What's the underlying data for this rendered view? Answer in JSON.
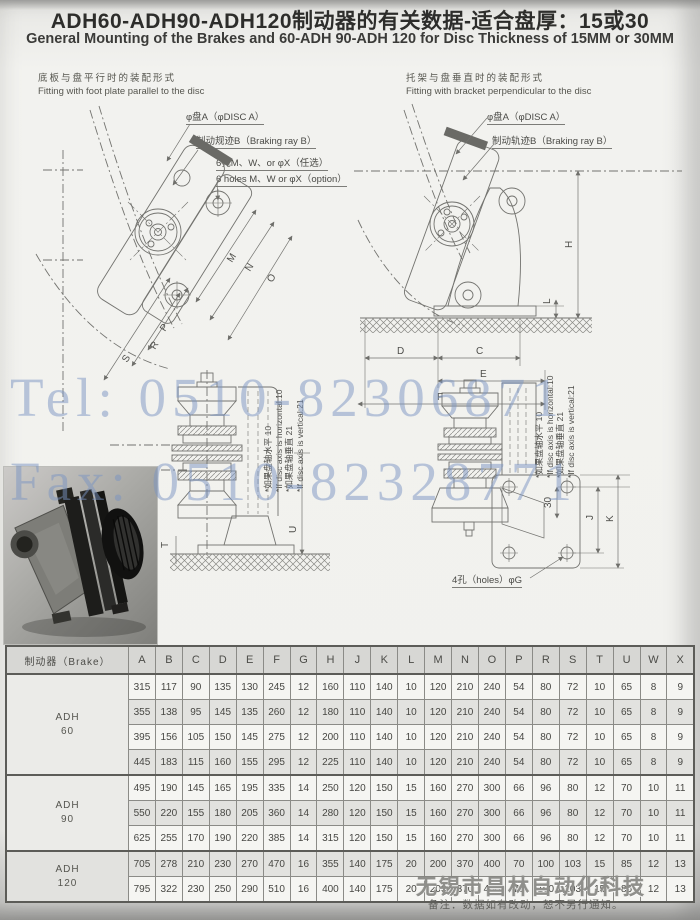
{
  "header": {
    "title_cn": "ADH60-ADH90-ADH120制动器的有关数据-适合盘厚：15或30",
    "title_en": "General Mounting of the Brakes and 60-ADH 90-ADH 120 for Disc Thickness of 15MM or 30MM"
  },
  "panels": {
    "left": {
      "caption_cn": "底板与盘平行时的装配形式",
      "caption_en": "Fitting with foot plate parallel to the disc",
      "callout_disc": "φ盘A（φDISC A）",
      "callout_ray": "制动规迹B（Braking ray B）",
      "callout_holes_cn": "6孔M、W、or φX（任选）",
      "callout_holes_en": "6 holes M、W or φX（option）",
      "dims": {
        "m": "M",
        "n": "N",
        "o": "O",
        "p": "P",
        "r": "R",
        "s": "S",
        "t": "T",
        "u": "U"
      }
    },
    "right": {
      "caption_cn": "托架与盘垂直时的装配形式",
      "caption_en": "Fitting with bracket perpendicular to the disc",
      "callout_disc": "φ盘A（φDISC A）",
      "callout_ray": "制动轨迹B（Braking ray B）",
      "holes_label": "4孔（holes）φG",
      "dims": {
        "d": "D",
        "c": "C",
        "e": "E",
        "f": "F",
        "h": "H",
        "l": "L",
        "j": "J",
        "k": "K",
        "offset": "30"
      }
    }
  },
  "annotations": {
    "line1_cn": "*如果盘轴水平  10",
    "line1_en": "*If disc axis is horizontal:10",
    "line2_cn": "*如果盘轴垂直  21",
    "line2_en": "*If disc axis is vertical:21"
  },
  "watermark": {
    "tel": "Tel: 0510-82306871",
    "fax": "Fax: 0510-82328771",
    "color": "#7a94c2"
  },
  "table": {
    "brake_header": "制动器（Brake）",
    "columns": [
      "A",
      "B",
      "C",
      "D",
      "E",
      "F",
      "G",
      "H",
      "J",
      "K",
      "L",
      "M",
      "N",
      "O",
      "P",
      "R",
      "S",
      "T",
      "U",
      "W",
      "X"
    ],
    "groups": [
      {
        "model": "ADH",
        "size": "60",
        "rows": [
          [
            315,
            117,
            90,
            135,
            130,
            245,
            12,
            160,
            110,
            140,
            10,
            120,
            210,
            240,
            54,
            80,
            72,
            10,
            65,
            8,
            9
          ],
          [
            355,
            138,
            95,
            145,
            135,
            260,
            12,
            180,
            110,
            140,
            10,
            120,
            210,
            240,
            54,
            80,
            72,
            10,
            65,
            8,
            9
          ],
          [
            395,
            156,
            105,
            150,
            145,
            275,
            12,
            200,
            110,
            140,
            10,
            120,
            210,
            240,
            54,
            80,
            72,
            10,
            65,
            8,
            9
          ],
          [
            445,
            183,
            115,
            160,
            155,
            295,
            12,
            225,
            110,
            140,
            10,
            120,
            210,
            240,
            54,
            80,
            72,
            10,
            65,
            8,
            9
          ]
        ]
      },
      {
        "model": "ADH",
        "size": "90",
        "rows": [
          [
            495,
            190,
            145,
            165,
            195,
            335,
            14,
            250,
            120,
            150,
            15,
            160,
            270,
            300,
            66,
            96,
            80,
            12,
            70,
            10,
            11
          ],
          [
            550,
            220,
            155,
            180,
            205,
            360,
            14,
            280,
            120,
            150,
            15,
            160,
            270,
            300,
            66,
            96,
            80,
            12,
            70,
            10,
            11
          ],
          [
            625,
            255,
            170,
            190,
            220,
            385,
            14,
            315,
            120,
            150,
            15,
            160,
            270,
            300,
            66,
            96,
            80,
            12,
            70,
            10,
            11
          ]
        ]
      },
      {
        "model": "ADH",
        "size": "120",
        "rows": [
          [
            705,
            278,
            210,
            230,
            270,
            470,
            16,
            355,
            140,
            175,
            20,
            200,
            370,
            400,
            70,
            100,
            103,
            15,
            85,
            12,
            13
          ],
          [
            795,
            322,
            230,
            250,
            290,
            510,
            16,
            400,
            140,
            175,
            20,
            200,
            370,
            400,
            70,
            100,
            103,
            15,
            85,
            12,
            13
          ]
        ]
      }
    ]
  },
  "footer": {
    "company": "无锡市昌林自动化科技",
    "note": "备注：数据如有改动，恕不另行通知。"
  }
}
